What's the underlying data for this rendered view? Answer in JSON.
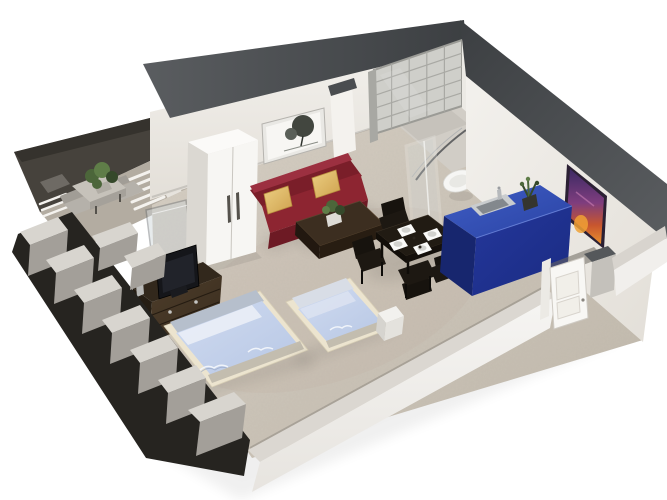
{
  "scene": {
    "type": "3d-floor-plan",
    "view": "isometric cutaway render of a studio apartment",
    "objects": [
      "balcony",
      "outdoor-table",
      "outdoor-chairs",
      "outdoor-plant",
      "sun-lounger",
      "cutaway-walls",
      "wardrobe",
      "sofa",
      "sofa-pillows",
      "coffee-table",
      "coffee-table-plant",
      "wall-art-tree",
      "glass-block-wall",
      "bathroom",
      "shower-enclosure",
      "toilet",
      "wall-painting",
      "kitchen-counter",
      "kitchen-sink",
      "counter-plant",
      "dining-table",
      "dining-chairs",
      "place-settings",
      "tv-cabinet",
      "tv",
      "double-bed",
      "single-bed",
      "nightstand",
      "entry-door",
      "front-wall"
    ]
  },
  "colors": {
    "background": "#ffffff",
    "wall_cap_light": "#5a5d60",
    "wall_cap_dark": "#3c3f42",
    "wall_face_light": "#f3f1ed",
    "wall_face_shaded": "#e3dfd8",
    "wall_face_white": "#f4f2ee",
    "bathroom_wall": "#eceae5",
    "pilaster_gray": "#c9c6c0",
    "floor_light": "#d8d1c6",
    "floor_dark": "#c0b8ab",
    "floor_bathroom": "#d1cdc6",
    "shower_tray": "#c6c2bb",
    "balcony_deck": "#46423c",
    "balcony_deck_dark": "#35322d",
    "balcony_floor": "#b3aca1",
    "outdoor_table": "#c6c2ba",
    "outdoor_table_side": "#a5a19a",
    "outdoor_chair": "#b5b1aa",
    "lounger_white": "#f4f2ee",
    "plant_green": "#4c663a",
    "plant_green_dark": "#35482a",
    "plant_green_light": "#5f7d48",
    "cut_block_top": "#d8d5cf",
    "cut_block_face": "#a39f99",
    "cut_gap": "#262420",
    "glass_block": "#cfcfca",
    "glass_joint": "#a9a9a4",
    "art_frame": "#e9e8e4",
    "art_paper": "#f7f6f3",
    "art_tree": "#42463f",
    "wardrobe_top": "#fbfaf8",
    "wardrobe_front": "#f7f6f3",
    "wardrobe_side": "#dbd8d2",
    "wardrobe_handle": "#55524c",
    "sofa_top": "#9c3040",
    "sofa_back": "#7a1e29",
    "sofa_seat": "#8d2531",
    "sofa_front": "#6d1a24",
    "pillow_light": "#eccf82",
    "pillow_dark": "#cfa24f",
    "pillow_edge": "#b98f3f",
    "coffee_top": "#3c2e20",
    "coffee_front": "#281d12",
    "coffee_side": "#221810",
    "dining_top": "#211b13",
    "dining_edge": "#15100b",
    "chair_black": "#17130e",
    "plate_white": "#fafaf8",
    "plate_gray": "#d2d2ce",
    "counter_top_light": "#3f5dc4",
    "counter_top": "#2a43a4",
    "counter_front": "#24379b",
    "counter_front_dark": "#1a2b82",
    "counter_end": "#17266e",
    "sink_rim": "#c9ccce",
    "sink_basin": "#83888d",
    "toilet_white": "#f6f6f4",
    "shower_frame": "#f4f4f1",
    "glass_edge_dark": "#3d4044",
    "painting_frame": "#2b2033",
    "painting_top": "#3c2a63",
    "painting_mid": "#7e3d7e",
    "painting_warm": "#c8562e",
    "painting_bottom": "#e8902f",
    "door_leaf": "#f8f7f4",
    "door_frame": "#eceae5",
    "door_gap": "#6b675f",
    "bed_frame": "#ece4cf",
    "bed_foot": "#c3bdaf",
    "bed_headboard": "#b6bfcc",
    "bed_blanket_light": "#cfdaf0",
    "bed_blanket": "#b7c7e4",
    "bed_pillow": "#eaeef7",
    "bed_pillow_gray": "#d8dde6",
    "cabinet_top": "#32281c",
    "cabinet_front_light": "#4d3d2a",
    "cabinet_front_dark": "#3a2d1f",
    "cabinet_side": "#261e14",
    "knob_silver": "#c4c4c2",
    "tv_screen": "#15161a",
    "nightstand": "#f2f1ee",
    "divider_sill": "#e6e3dd",
    "glass_panel": "#ccd3d6",
    "outer_face_light": "#f6f5f3",
    "outer_face_dark": "#e7e4df",
    "shadow": "#000000"
  }
}
